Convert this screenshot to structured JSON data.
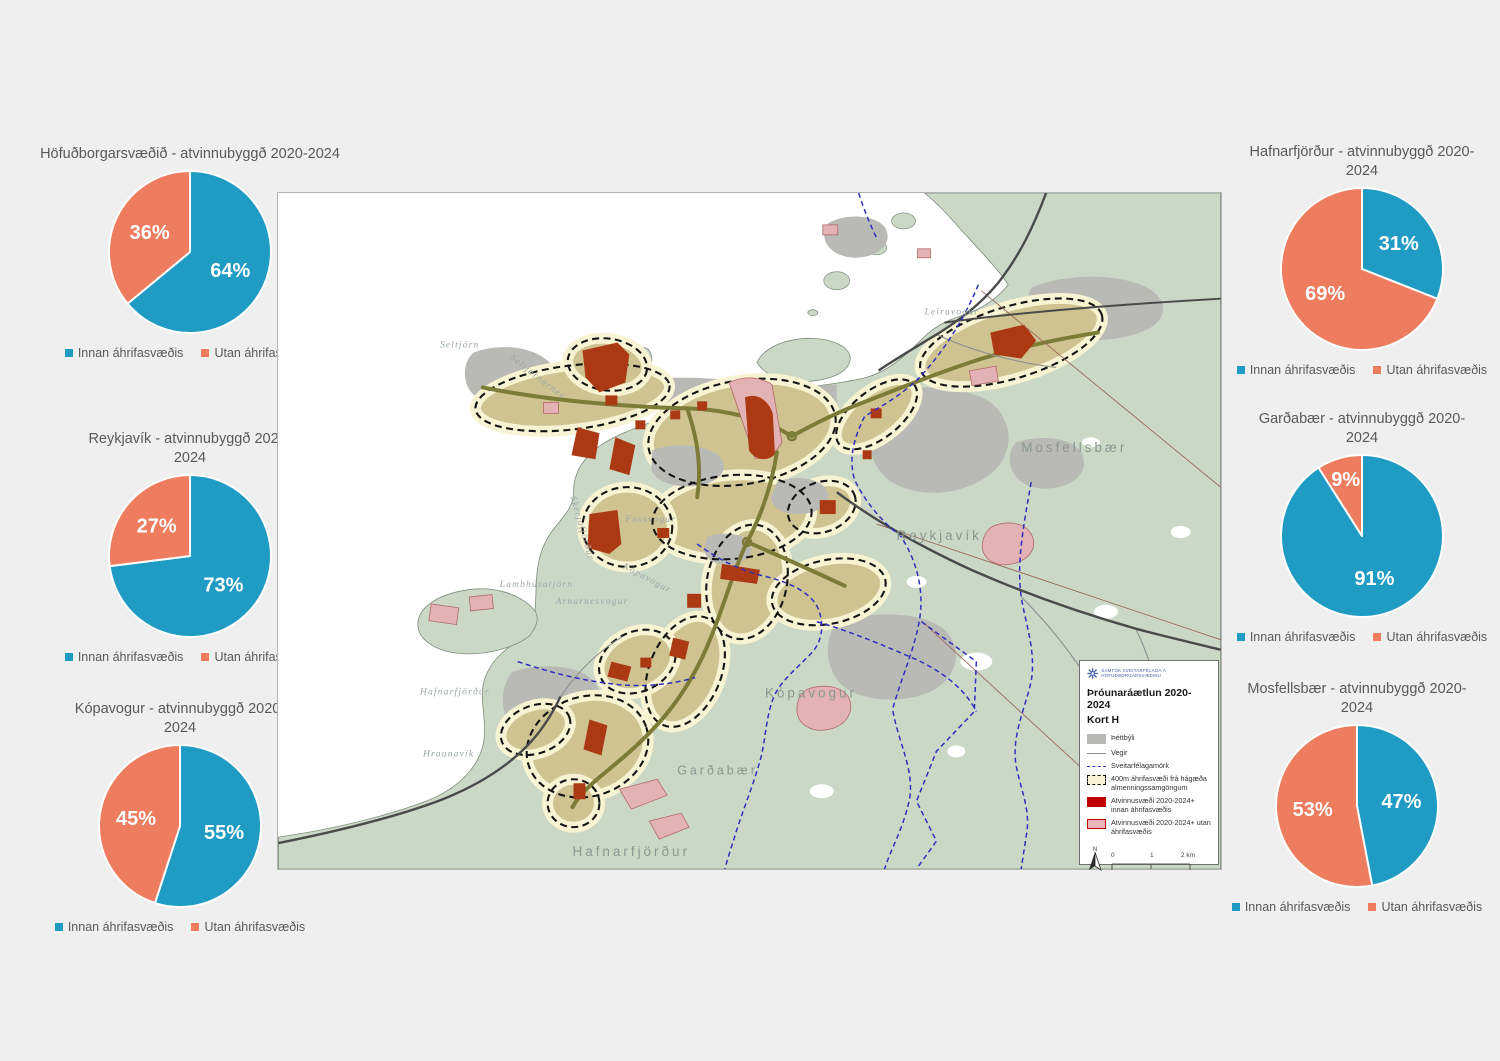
{
  "page": {
    "title": "Þróunaráætlun 2020-2024 - Kort H"
  },
  "colors": {
    "pie_innan": "#1f9bc4",
    "pie_utan": "#ee7c5e",
    "land": "#ccd8c6",
    "urban": "#b9b9b6",
    "corridor_fill": "#cfc391",
    "corridor_fringe": "#f8f3d2",
    "employment_innan": "#ab3914",
    "employment_utan": "#e2b2b5",
    "municipal_boundary": "#2f2fbe"
  },
  "chart_data": [
    {
      "type": "pie",
      "title": "Höfuðborgarsvæðið - atvinnubyggð 2020-2024",
      "labels": [
        "Innan áhrifasvæðis",
        "Utan áhrifasvæðis"
      ],
      "values": [
        64,
        36
      ],
      "value_labels": [
        "64%",
        "36%"
      ],
      "colors": [
        "#1f9bc4",
        "#ee7c5e"
      ],
      "legend_position": "bottom"
    },
    {
      "type": "pie",
      "title": "Reykjavík - atvinnubyggð 2020-2024",
      "labels": [
        "Innan áhrifasvæðis",
        "Utan áhrifasvæðis"
      ],
      "values": [
        73,
        27
      ],
      "value_labels": [
        "73%",
        "27%"
      ],
      "colors": [
        "#1f9bc4",
        "#ee7c5e"
      ],
      "legend_position": "bottom"
    },
    {
      "type": "pie",
      "title": "Kópavogur - atvinnubyggð 2020-2024",
      "labels": [
        "Innan áhrifasvæðis",
        "Utan áhrifasvæðis"
      ],
      "values": [
        55,
        45
      ],
      "value_labels": [
        "55%",
        "45%"
      ],
      "colors": [
        "#1f9bc4",
        "#ee7c5e"
      ],
      "legend_position": "bottom"
    },
    {
      "type": "pie",
      "title": "Hafnarfjörður - atvinnubyggð 2020-2024",
      "labels": [
        "Innan áhrifasvæðis",
        "Utan áhrifasvæðis"
      ],
      "values": [
        31,
        69
      ],
      "value_labels": [
        "31%",
        "69%"
      ],
      "colors": [
        "#1f9bc4",
        "#ee7c5e"
      ],
      "legend_position": "bottom"
    },
    {
      "type": "pie",
      "title": "Garðabær - atvinnubyggð 2020-2024",
      "labels": [
        "Innan áhrifasvæðis",
        "Utan áhrifasvæðis"
      ],
      "values": [
        91,
        9
      ],
      "value_labels": [
        "91%",
        "9%"
      ],
      "colors": [
        "#1f9bc4",
        "#ee7c5e"
      ],
      "legend_position": "bottom"
    },
    {
      "type": "pie",
      "title": "Mosfellsbær - atvinnubyggð 2020-2024",
      "labels": [
        "Innan áhrifasvæðis",
        "Utan áhrifasvæðis"
      ],
      "values": [
        47,
        53
      ],
      "value_labels": [
        "47%",
        "53%"
      ],
      "colors": [
        "#1f9bc4",
        "#ee7c5e"
      ],
      "legend_position": "bottom"
    }
  ],
  "map": {
    "labels": {
      "seltjorn": "Seltjörn",
      "seltjarnarnes": "Seltjarnarnes",
      "leiruvogur": "Leiruvogur",
      "mosfellsbaer": "Mosfellsbær",
      "reykjavik": "Reykjavík",
      "fossvogur": "Fossvogur",
      "skerjafjordur": "Skerjafjörður",
      "kopavogur_inlet": "Kópavogur",
      "lambhusatjorn": "Lambhúsatjörn",
      "arnarnesvogur": "Arnarnesvogur",
      "hafnarfjordur_bay": "Hafnarfjörður",
      "hraunavik": "Hraunavík",
      "gardabaer": "Garðabær",
      "hafnarfjordur_town": "Hafnarfjörður",
      "kopavogur_town": "Kópavogur"
    },
    "legend": {
      "org": "SAMTÖK SVEITARFÉLAGA Á HÖFUÐBORGARSVÆÐINU",
      "title": "Þróunaráætlun 2020-2024",
      "subtitle": "Kort H",
      "items": [
        {
          "label": "Þéttbýli"
        },
        {
          "label": "Vegir"
        },
        {
          "label": "Sveitarfélagamörk"
        },
        {
          "label": "400m áhrifasvæði frá hágæða almenningssamgöngum"
        },
        {
          "label": "Atvinnusvæði 2020-2024+ innan áhrifasvæðis"
        },
        {
          "label": "Atvinnusvæði 2020-2024+ utan áhrifasvæðis"
        }
      ],
      "north": "N",
      "scale": {
        "t0": "0",
        "t1": "1",
        "t2": "2 km"
      }
    }
  }
}
